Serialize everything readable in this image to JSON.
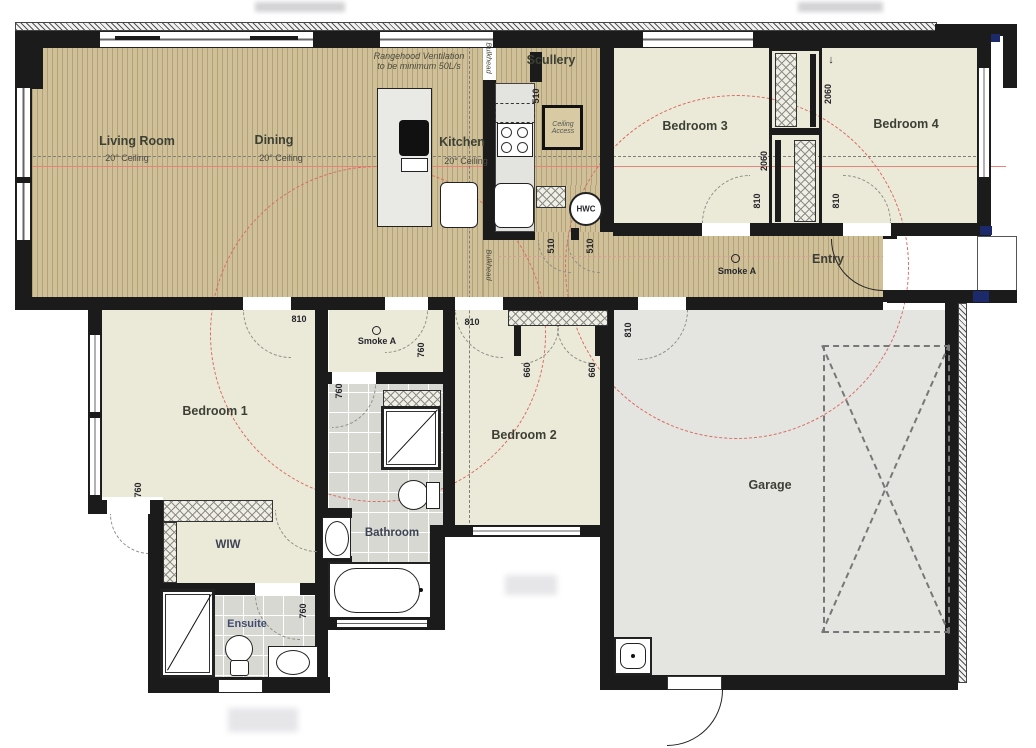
{
  "rooms": {
    "living": {
      "name": "Living Room",
      "ceiling": "20° Ceiling"
    },
    "dining": {
      "name": "Dining",
      "ceiling": "20° Ceiling"
    },
    "kitchen": {
      "name": "Kitchen",
      "ceiling": "20° Ceiling"
    },
    "scullery": {
      "name": "Scullery"
    },
    "bedroom1": {
      "name": "Bedroom 1"
    },
    "bedroom2": {
      "name": "Bedroom 2"
    },
    "bedroom3": {
      "name": "Bedroom 3"
    },
    "bedroom4": {
      "name": "Bedroom 4"
    },
    "entry": {
      "name": "Entry"
    },
    "garage": {
      "name": "Garage"
    },
    "bathroom": {
      "name": "Bathroom"
    },
    "ensuite": {
      "name": "Ensuite"
    },
    "wiw": {
      "name": "WIW"
    }
  },
  "annotations": {
    "rangehood_note": "Rangehood Ventilation to be minimum 50L/s",
    "ceiling_access": "Ceiling Access",
    "bulkhead": "Bulkhead",
    "hwc": "HWC",
    "smoke_detector": "Smoke A",
    "slide_arrow": "↓"
  },
  "dimensions": {
    "door_810": "810",
    "door_760": "760",
    "door_660": "660",
    "opening_510": "510",
    "wardrobe_2060": "2060"
  },
  "colors": {
    "timber_floor": "#cfc09a",
    "carpet_floor": "#ebe9d8",
    "tile_floor": "#d8d8d3",
    "garage_floor": "#e4e4e1",
    "wall": "#1b1b1b",
    "smoke_coverage_circle": "#d96a5e",
    "section_line": "#e8837a"
  }
}
